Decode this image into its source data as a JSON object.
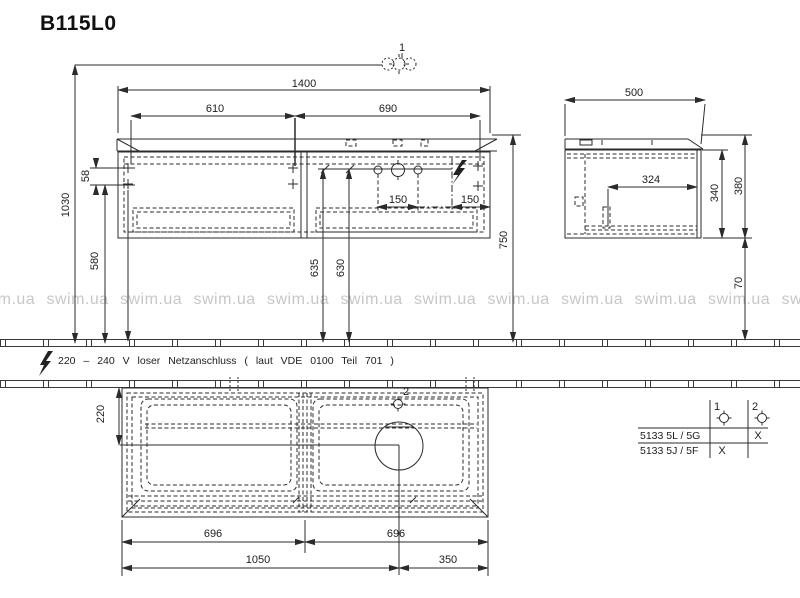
{
  "title": "B115L0",
  "watermark": "swim.ua",
  "note": "220 – 240 V loser Netzanschluss ( laut VDE 0100 Teil 701 )",
  "callouts": {
    "faucet_marker": "1",
    "drain_marker": "2"
  },
  "dims": {
    "front_total_width": "1400",
    "front_left_section": "610",
    "front_right_section": "690",
    "height_total": "1030",
    "outlet_gap": "58",
    "outlet_height": "580",
    "drain_left": "635",
    "drain_right": "630",
    "worktop_height": "750",
    "tap_spacing_left": "150",
    "tap_spacing_right": "150",
    "side_depth": "500",
    "side_clearance": "324",
    "side_inner_height": "340",
    "side_total_height": "380",
    "side_bottom_gap": "70",
    "basin_center_depth": "220",
    "plan_left_drawer": "696",
    "plan_right_drawer": "696",
    "plan_basin_center": "1050",
    "plan_basin_edge": "350"
  },
  "variant_table": {
    "col_headers": [
      "1",
      "2"
    ],
    "rows": [
      {
        "model": "5133 5L / 5G",
        "marks": [
          "",
          "X"
        ]
      },
      {
        "model": "5133 5J / 5F",
        "marks": [
          "X",
          ""
        ]
      }
    ]
  }
}
